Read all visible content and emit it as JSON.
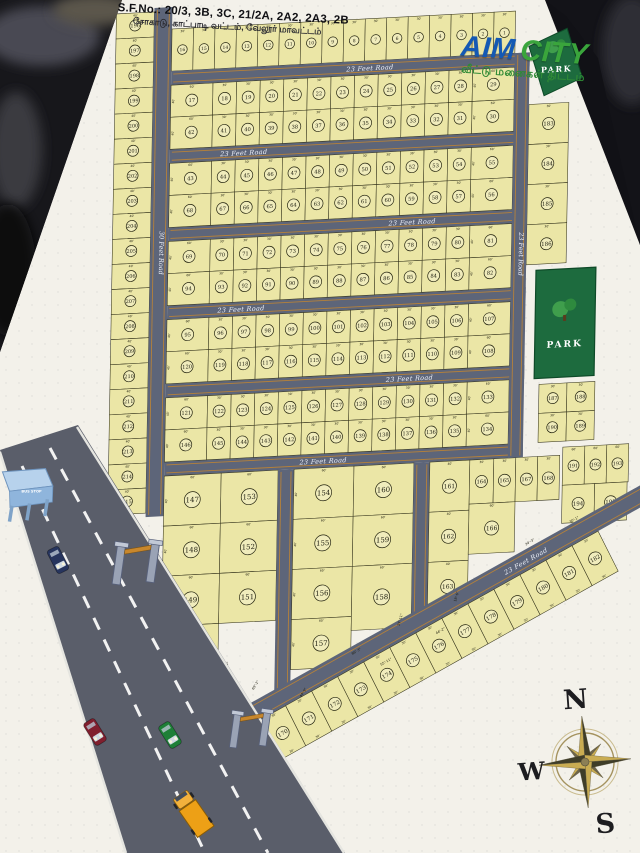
{
  "photo": {
    "background": "#111116",
    "paper": "#f3f1ea"
  },
  "header": {
    "sf_no": "S.F.No.: 20/3, 3B, 3C, 21/2A, 2A2, 2A3, 2B",
    "location_tamil": "சோகாடு, காட்பாடி வட்டம், வேலூர் மாவட்டம்"
  },
  "logo": {
    "aim": "AIM",
    "city": "CITY",
    "tagline_tamil": "வீட்டு மனைகள் திட்டம்",
    "aim_color": "#1459b4",
    "city_color": "#3aa53c"
  },
  "map": {
    "colors": {
      "plot": "#ebe6a6",
      "plot_stroke": "#35341c",
      "road": "#5d6579",
      "road_stripe": "#b5813a",
      "park": "#1d6b3e",
      "label": "#edf0f8"
    },
    "road_label_h": "23 Feet Road",
    "road_label_v_left": "30 Feet Road",
    "road_label_v_right": "23 Feet Road",
    "road_label_diag": "23 Feet Road",
    "park_label": "PARK",
    "dims": {
      "narrow": "30'",
      "wide": "60'",
      "depth": "40'",
      "left_w": "40'",
      "left_d": "30'",
      "cut": [
        "76'-5\"",
        "54'-6\"",
        "14'-6\"",
        "69'-2\"",
        "66'-3\"",
        "27'-11\"",
        "55'-11\"",
        "18'-6\"",
        "44'-2\"",
        "34'-3\"",
        "30'-1\"",
        "44'-9\""
      ]
    },
    "top_row": [
      16,
      15,
      14,
      13,
      12,
      11,
      10,
      9,
      8,
      7,
      6,
      5,
      4,
      3,
      2,
      1
    ],
    "bands": [
      {
        "row1": [
          17,
          18,
          19,
          20,
          21,
          22,
          23,
          24,
          25,
          26,
          27,
          28,
          29
        ],
        "row2": [
          42,
          41,
          40,
          39,
          38,
          37,
          36,
          35,
          34,
          33,
          32,
          31,
          30
        ]
      },
      {
        "row1": [
          43,
          44,
          45,
          46,
          47,
          48,
          49,
          50,
          51,
          52,
          53,
          54,
          55
        ],
        "row2": [
          68,
          67,
          66,
          65,
          64,
          63,
          62,
          61,
          60,
          59,
          58,
          57,
          56
        ]
      },
      {
        "row1": [
          69,
          70,
          71,
          72,
          73,
          74,
          75,
          76,
          77,
          78,
          79,
          80,
          81
        ],
        "row2": [
          94,
          93,
          92,
          91,
          90,
          89,
          88,
          87,
          86,
          85,
          84,
          83,
          82
        ]
      },
      {
        "row1": [
          95,
          96,
          97,
          98,
          99,
          100,
          101,
          102,
          103,
          104,
          105,
          106,
          107
        ],
        "row2": [
          120,
          119,
          118,
          117,
          116,
          115,
          114,
          113,
          112,
          111,
          110,
          109,
          108
        ]
      },
      {
        "row1": [
          121,
          122,
          123,
          124,
          125,
          126,
          127,
          128,
          129,
          130,
          131,
          132,
          133
        ],
        "row2": [
          146,
          145,
          144,
          143,
          142,
          141,
          140,
          139,
          138,
          137,
          136,
          135,
          134
        ]
      }
    ],
    "left_column": [
      196,
      197,
      198,
      199,
      200,
      201,
      202,
      203,
      204,
      205,
      206,
      207,
      208,
      209,
      210,
      211,
      212,
      213,
      214,
      215
    ],
    "bottom_blocks": {
      "block1": {
        "colA": [
          147,
          148,
          149,
          150
        ],
        "colB": [
          153,
          152,
          151
        ]
      },
      "block2": {
        "colA": [
          154,
          155,
          156,
          157
        ],
        "colB": [
          160,
          159,
          158
        ]
      },
      "block3": {
        "col": [
          161,
          162,
          163
        ],
        "row": [
          164,
          165,
          167,
          168
        ],
        "below": [
          166
        ]
      }
    },
    "diagonal_strip": [
      169,
      170,
      171,
      172,
      173,
      174,
      175,
      176,
      177,
      178,
      179,
      180,
      181,
      182
    ],
    "right_side": {
      "stack": [
        183,
        184,
        185,
        186
      ],
      "grid": [
        [
          187,
          188
        ],
        [
          190,
          189
        ]
      ],
      "block_row1": [
        191,
        192,
        193
      ],
      "block_row2": [
        194,
        195
      ]
    }
  },
  "street": {
    "bus_stop_label": "BUS STOP",
    "vehicles": [
      {
        "name": "car-maroon",
        "color": "#801f2e"
      },
      {
        "name": "car-navy",
        "color": "#27355e"
      },
      {
        "name": "car-green",
        "color": "#1e7f37"
      },
      {
        "name": "truck-orange",
        "color": "#eda016"
      }
    ]
  },
  "compass": {
    "north": "N",
    "west": "W",
    "south": "S"
  }
}
